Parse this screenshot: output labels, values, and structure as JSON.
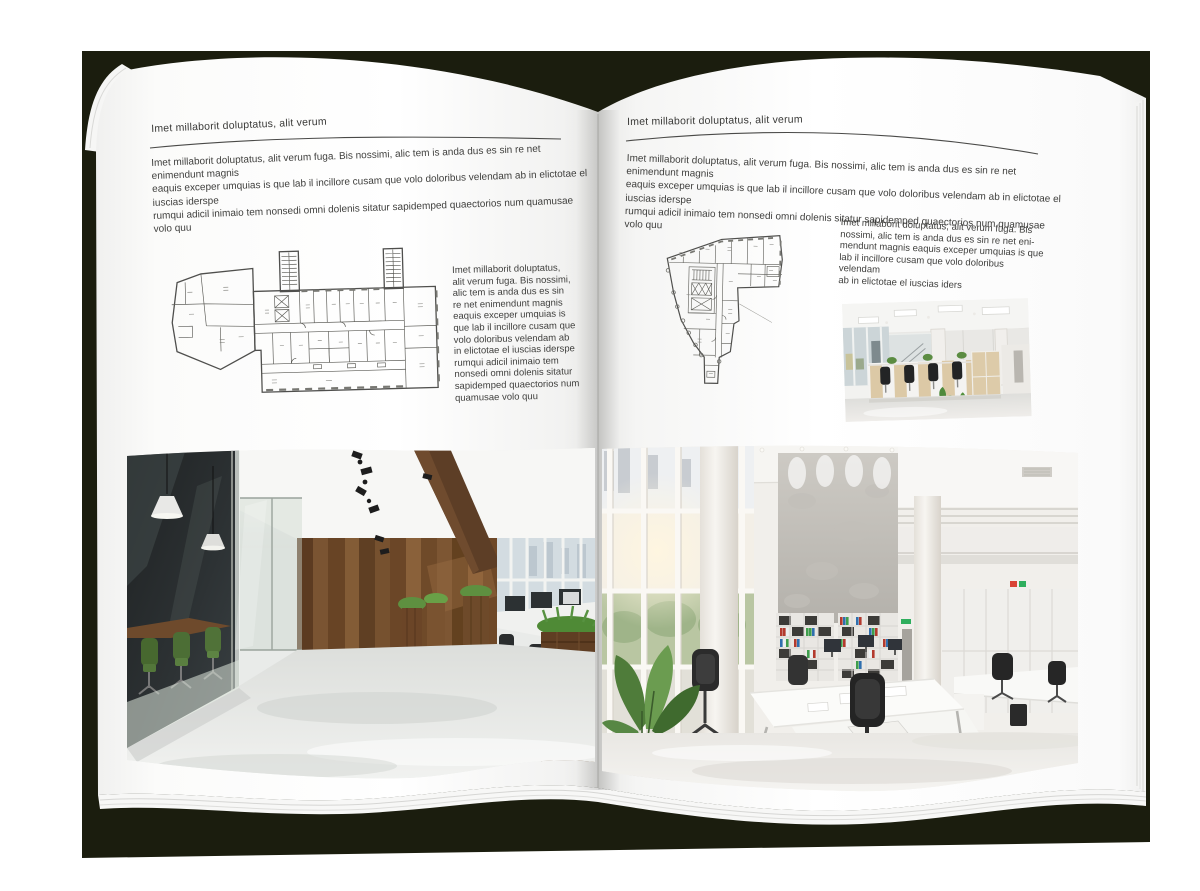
{
  "palette": {
    "backdrop": "#1b1d0e",
    "page": "#ffffff",
    "text": "#3f3f3d",
    "rule": "#4a4a48",
    "plan_line": "#4f4f4d",
    "wood": "#6b4628",
    "plant_green": "#5e9040",
    "chair_green": "#4c6e35",
    "binder_red": "#b33a2e",
    "binder_green": "#3f9e4d",
    "binder_blue": "#2f6fae"
  },
  "page_left": {
    "header": "Imet millaborit doluptatus, alit verum",
    "intro": "Imet millaborit doluptatus, alit verum fuga. Bis nossimi, alic tem is anda dus es sin re net enimendunt magnis\neaquis exceper umquias is que lab il incillore cusam que volo doloribus velendam ab in elictotae el iuscias iderspe\nrumqui adicil inimaio tem nonsedi omni dolenis sitatur sapidemped quaectorios num quamusae volo quu",
    "side_text": "Imet millaborit doluptatus,\nalit verum fuga. Bis nossimi,\nalic tem is anda dus es sin\nre net enimendunt magnis\neaquis exceper umquias is\nque lab il incillore cusam que\nvolo doloribus velendam ab\nin elictotae el iuscias iderspe\nrumqui adicil inimaio tem\nnonsedi omni dolenis sitatur\nsapidemped quaectorios num\nquamusae volo quu"
  },
  "page_right": {
    "header": "Imet millaborit doluptatus, alit verum",
    "intro": "Imet millaborit doluptatus, alit verum fuga. Bis nossimi, alic tem is anda dus es sin re net enimendunt magnis\neaquis exceper umquias is que lab il incillore cusam que volo doloribus velendam ab in elictotae el iuscias iderspe\nrumqui adicil inimaio tem nonsedi omni dolenis sitatur sapidemped quaectorios num quamusae volo quu",
    "side_text": "Imet millaborit doluptatus, alit verum fuga. Bis\nnossimi, alic tem is anda dus es sin re net eni-\nmendunt magnis eaquis exceper umquias is que\nlab il incillore cusam que volo doloribus velendam\nab in elictotae el iuscias iders"
  }
}
